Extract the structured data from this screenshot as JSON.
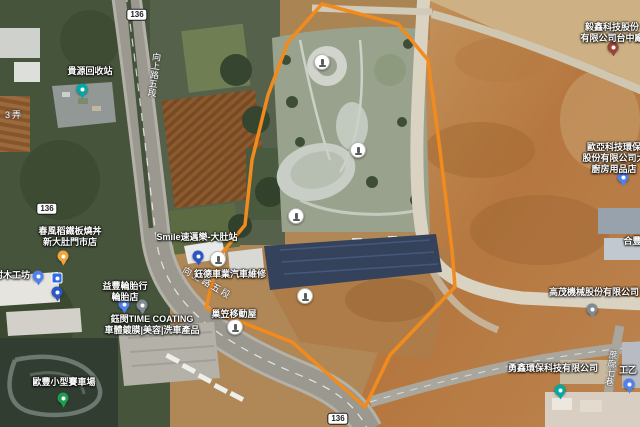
{
  "map": {
    "accent_color": "#F28B1D",
    "polygon_points": "322,4 288,42 268,95 252,160 245,225 218,258 206,308 292,342 365,407 390,355 455,287 452,250 440,150 428,60 398,24",
    "route_shields": [
      {
        "label": "136",
        "x": 137,
        "y": 15
      },
      {
        "label": "136",
        "x": 47,
        "y": 209
      },
      {
        "label": "136",
        "x": 338,
        "y": 419
      }
    ],
    "road_labels": [
      {
        "text": "向上路五段",
        "x": 149,
        "y": 52,
        "rotate": 7,
        "vertical": true
      },
      {
        "text": "向上路五段",
        "x": 180,
        "y": 276,
        "rotate": 30,
        "vertical": false
      },
      {
        "text": "蔗廍七巷",
        "x": 606,
        "y": 350,
        "rotate": 8,
        "vertical": true
      },
      {
        "text": "3弄",
        "x": 5,
        "y": 108,
        "rotate": 0,
        "vertical": false
      }
    ],
    "pois": [
      {
        "id": "guiyuan",
        "lines": [
          "貴源回收站"
        ],
        "x": 90,
        "y": 66,
        "pin": {
          "type": "pin",
          "color": "#00A9A5",
          "x": 82,
          "y": 89
        }
      },
      {
        "id": "chunfeng",
        "lines": [
          "春風稻鐵板燒丼",
          "新大肚門市店"
        ],
        "x": 70,
        "y": 226,
        "pin": {
          "type": "pin",
          "color": "#F2A43A",
          "x": 63,
          "y": 256
        }
      },
      {
        "id": "mucun",
        "lines": [
          "村木工坊"
        ],
        "x": 12,
        "y": 270,
        "pin": {
          "type": "pin",
          "color": "#4E80EE",
          "x": 38,
          "y": 276
        }
      },
      {
        "id": "yifeng",
        "lines": [
          "益豐輪胎行",
          "輪胎店"
        ],
        "x": 125,
        "y": 281,
        "pin": {
          "type": "pin",
          "color": "#4E80EE",
          "x": 124,
          "y": 304
        }
      },
      {
        "id": "yumin",
        "lines": [
          "鈺閔TIME COATING",
          "車體鍍膜|美容|洗車產品"
        ],
        "x": 152,
        "y": 314,
        "pin": null
      },
      {
        "id": "oufeng",
        "lines": [
          "歐豐小型賽車場"
        ],
        "x": 64,
        "y": 377,
        "pin": {
          "type": "pin",
          "color": "#1D9D50",
          "x": 63,
          "y": 398
        }
      },
      {
        "id": "smile",
        "lines": [
          "Smile速邁樂-大肚站"
        ],
        "x": 197,
        "y": 232,
        "pin": {
          "type": "pin",
          "color": "#2A56C6",
          "x": 198,
          "y": 256
        }
      },
      {
        "id": "yude",
        "lines": [
          "鈺德車業汽車維修"
        ],
        "x": 230,
        "y": 269,
        "pin": null
      },
      {
        "id": "chaoli",
        "lines": [
          "巢笠移動屋"
        ],
        "x": 234,
        "y": 309,
        "pin": {
          "type": "circle",
          "x": 235,
          "y": 327
        }
      },
      {
        "id": "yixin",
        "lines": [
          "毅鑫科技股份",
          "有限公司台中廠"
        ],
        "x": 612,
        "y": 22,
        "pin": {
          "type": "pin",
          "color": "#9A4238",
          "x": 613,
          "y": 47
        }
      },
      {
        "id": "ouya",
        "lines": [
          "歐亞科技環保",
          "股份有限公司大",
          "廚房用品店"
        ],
        "x": 614,
        "y": 142,
        "pin": {
          "type": "pin",
          "color": "#4E80EE",
          "x": 623,
          "y": 177
        }
      },
      {
        "id": "hegang",
        "lines": [
          "合豐鋼"
        ],
        "x": 637,
        "y": 236,
        "pin": null
      },
      {
        "id": "gaomao",
        "lines": [
          "高茂機械股份有限公司"
        ],
        "x": 594,
        "y": 287,
        "pin": {
          "type": "pin",
          "color": "#808A93",
          "x": 592,
          "y": 309
        }
      },
      {
        "id": "yongxin",
        "lines": [
          "勇鑫環保科技有限公司"
        ],
        "x": 553,
        "y": 363,
        "pin": {
          "type": "pin",
          "color": "#00A9A5",
          "x": 560,
          "y": 390
        }
      },
      {
        "id": "gongyi",
        "lines": [
          "工乙"
        ],
        "x": 628,
        "y": 365,
        "pin": {
          "type": "pin",
          "color": "#4E80EE",
          "x": 629,
          "y": 384
        }
      }
    ],
    "pins": [
      {
        "type": "fuel",
        "x": 57,
        "y": 278
      },
      {
        "type": "pin",
        "color": "#2A56C6",
        "x": 57,
        "y": 292
      },
      {
        "type": "pin",
        "color": "#808A93",
        "x": 142,
        "y": 305
      },
      {
        "type": "circle",
        "x": 218,
        "y": 259
      }
    ],
    "park_markers": [
      {
        "x": 322,
        "y": 62
      },
      {
        "x": 358,
        "y": 150
      },
      {
        "x": 296,
        "y": 216
      },
      {
        "x": 305,
        "y": 296
      }
    ]
  }
}
